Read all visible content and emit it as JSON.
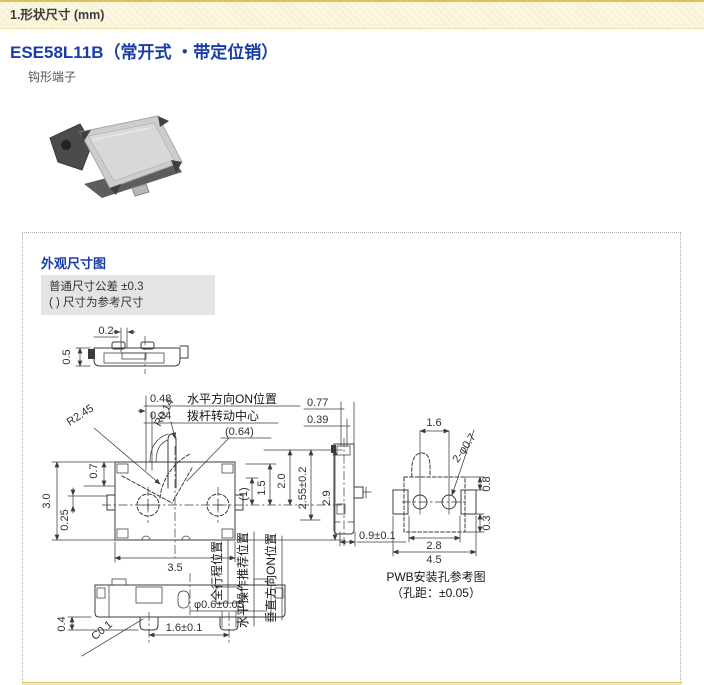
{
  "header": {
    "section_title": "1.形状尺寸 (mm)"
  },
  "product": {
    "model_title": "ESE58L11B（常开式 ・带定位销）",
    "terminal_type": "钩形端子"
  },
  "outline_box": {
    "title": "外观尺寸图",
    "note_line1": "普通尺寸公差 ±0.3",
    "note_line2": "( ) 尺寸为参考尺寸"
  },
  "drawing": {
    "top_profile": {
      "d02": "0.2",
      "d05": "0.5"
    },
    "front": {
      "on_h_label": "水平方向ON位置",
      "pivot_label": "拨杆转动中心",
      "d048": "0.48",
      "d024": "0.24",
      "d064": "(0.64)",
      "r014": "R0.14",
      "r245": "R2.45",
      "d30": "3.0",
      "d025": "0.25",
      "d07": "0.7",
      "d35": "3.5",
      "d1": "(1)",
      "d15": "1.5",
      "d20": "2.0",
      "d255": "2.55±0.2",
      "d29": "2.9"
    },
    "side": {
      "d077": "0.77",
      "d039": "0.39",
      "d09": "0.9±0.1"
    },
    "positions": {
      "full_travel": "全行程位置",
      "h_recommended": "水平操作推荐位置",
      "v_on": "垂直方向ON位置"
    },
    "bottom": {
      "d04": "0.4",
      "c01": "C0.1",
      "phi06": "φ0.6±0.05",
      "d16": "1.6±0.1"
    },
    "pwb": {
      "d16": "1.6",
      "holes": "2-φ0.7",
      "d08": "0.8",
      "d03": "0.3",
      "d28": "2.8",
      "d45": "4.5",
      "caption1": "PWB安装孔参考图",
      "caption2": "（孔距：±0.05）"
    }
  },
  "colors": {
    "accent_blue": "#1a3ca8",
    "section_bar_bg": "#f8f3d5",
    "note_bg": "#e4e4e4"
  }
}
